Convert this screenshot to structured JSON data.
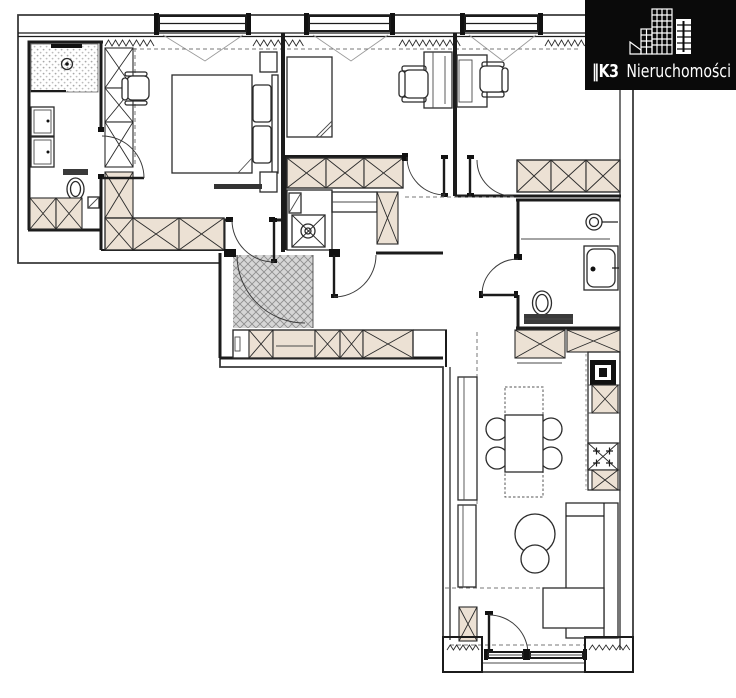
{
  "watermark": {
    "brand_prefix": "‖K3",
    "brand_name": "Nieruchomości",
    "icon": "city-buildings-logo-icon",
    "background_color": "#0a0a0a",
    "text_color": "#ffffff"
  },
  "floorplan": {
    "background_color": "#ffffff",
    "wall_color": "#1b1b1b",
    "cabinet_fill_color": "#ece1d4",
    "entrance_mat_fill_color": "#d6d6d6",
    "elements": [
      "bathroom-shower",
      "bathroom-vanity-units",
      "bathroom-toilet",
      "bathroom-cabinets",
      "bedroom-double-bed",
      "bedroom-nightstands",
      "bedroom-wardrobe-column",
      "bedroom-wardrobe-row",
      "bedroom-desk-chair",
      "office-1-desk",
      "office-1-chair",
      "office-1-closet",
      "office-2-desk",
      "office-2-chair",
      "office-2-wardrobe",
      "laundry-washing-machine",
      "laundry-counter",
      "entrance-mat",
      "entrance-door",
      "hallway-cabinet-row",
      "corridor-cabinet-row",
      "bathroom-2-washbasin",
      "bathroom-2-bathtub",
      "bathroom-2-toilet",
      "kitchen-corner-counter",
      "kitchen-tall-units",
      "kitchen-oven",
      "kitchen-hob",
      "dining-table",
      "dining-chairs",
      "sofa",
      "ottoman",
      "coffee-tables",
      "tv-wall-units",
      "balcony-door",
      "windows",
      "interior-doors"
    ]
  }
}
